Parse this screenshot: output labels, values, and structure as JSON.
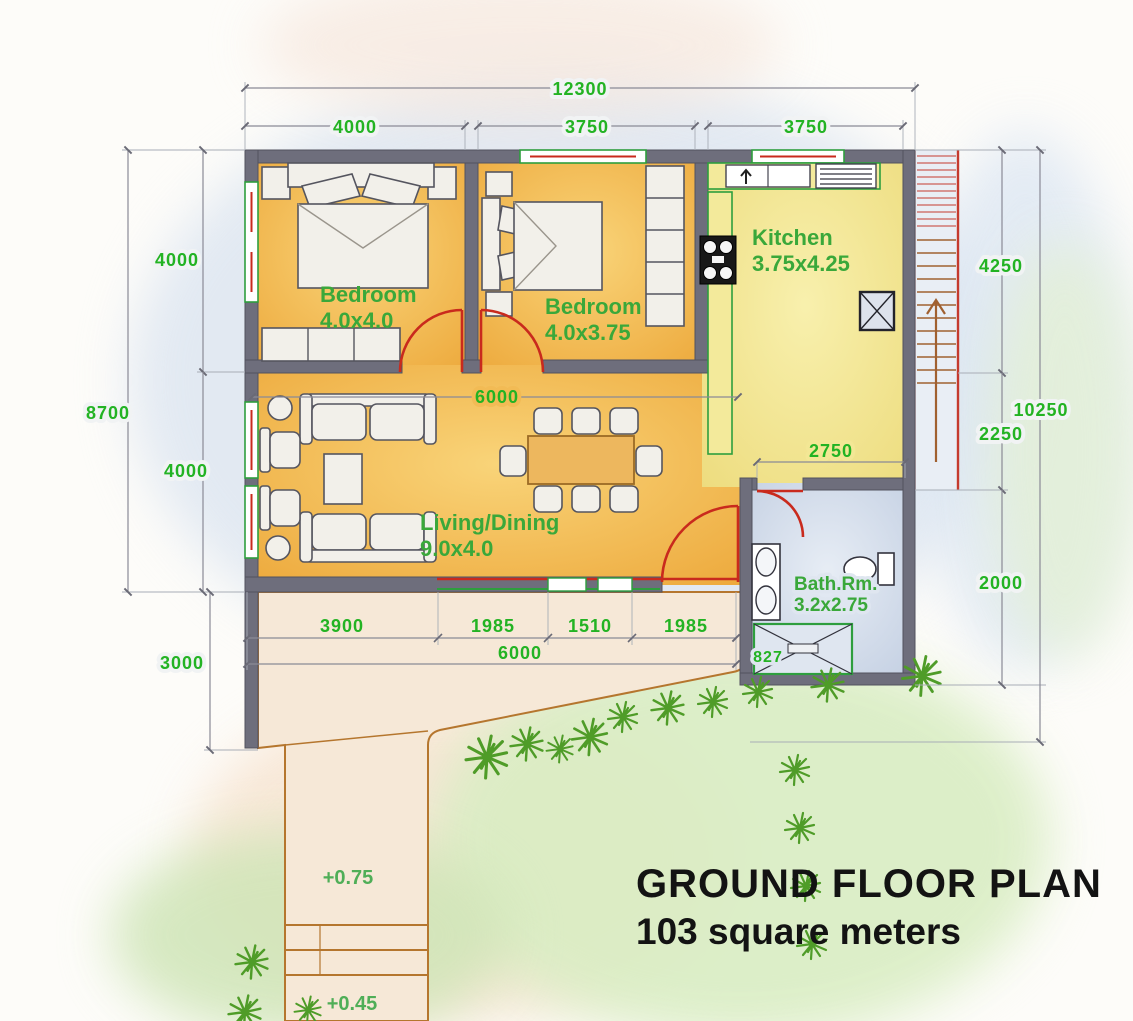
{
  "title": {
    "line1": "GROUND FLOOR PLAN",
    "line2": "103 square meters"
  },
  "rooms": {
    "bedroom1": {
      "name": "Bedroom",
      "size": "4.0x4.0"
    },
    "bedroom2": {
      "name": "Bedroom",
      "size": "4.0x3.75"
    },
    "kitchen": {
      "name": "Kitchen",
      "size": "3.75x4.25"
    },
    "living": {
      "name": "Living/Dining",
      "size": "9.0x4.0"
    },
    "bath": {
      "name": "Bath.Rm.",
      "size": "3.2x2.75"
    }
  },
  "dims": {
    "overall_width": "12300",
    "top_left": "4000",
    "top_mid": "3750",
    "top_right": "3750",
    "left_outer": "8700",
    "left_top": "4000",
    "left_bottom": "4000",
    "left_terrace": "3000",
    "right_kitchen": "4250",
    "right_outer": "10250",
    "right_mid": "2250",
    "right_bath": "2000",
    "living_opening": "6000",
    "hall_width": "2750",
    "south_1": "3900",
    "south_2": "1985",
    "south_3": "1510",
    "south_4": "1985",
    "terrace_width": "6000",
    "tub": "827"
  },
  "levels": {
    "terrace": "+0.75",
    "steps": "+0.45"
  },
  "colors": {
    "wall": "#6e6e7c",
    "annotation_green": "#23b323",
    "door_red": "#c92a1d",
    "floor_bedroom": "#f3b647",
    "floor_kitchen": "#f1e38c",
    "floor_bath": "#ccd7e8",
    "counter_green": "#2e9e3e",
    "terrace": "#f6e8d7",
    "terrace_line": "#b5762e",
    "tree": "#4f9c28",
    "dim_line": "#8a8a96",
    "title_text": "#131313"
  }
}
